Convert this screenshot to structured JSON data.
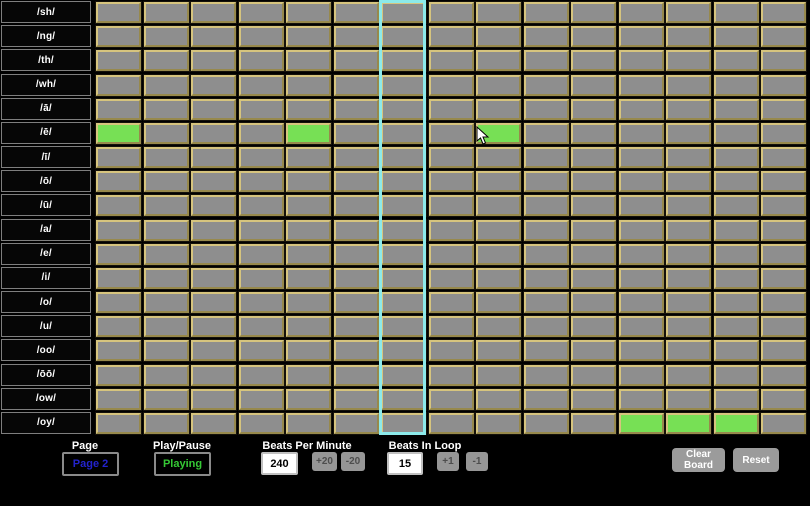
{
  "grid": {
    "row_labels": [
      "/sh/",
      "/ng/",
      "/th/",
      "/wh/",
      "/ā/",
      "/ē/",
      "/ī/",
      "/ō/",
      "/ū/",
      "/a/",
      "/e/",
      "/i/",
      "/o/",
      "/u/",
      "/oo/",
      "/ōō/",
      "/ow/",
      "/oy/"
    ],
    "num_columns": 15,
    "active_cells": [
      {
        "row": 5,
        "col": 0
      },
      {
        "row": 5,
        "col": 4
      },
      {
        "row": 5,
        "col": 8
      },
      {
        "row": 17,
        "col": 11
      },
      {
        "row": 17,
        "col": 12
      },
      {
        "row": 17,
        "col": 13
      }
    ],
    "playhead_column": 6,
    "colors": {
      "background": "#000000",
      "cell_fill": "#8e8e8e",
      "cell_border": "#c4b271",
      "active_cell": "#77e055",
      "playhead": "#8ceaea"
    }
  },
  "controls": {
    "page": {
      "label": "Page",
      "value": "Page 2",
      "value_color": "#2323cc"
    },
    "play_pause": {
      "label": "Play/Pause",
      "value": "Playing",
      "value_color": "#35c935"
    },
    "bpm": {
      "label": "Beats Per Minute",
      "value": "240",
      "increment_label": "+20",
      "decrement_label": "-20"
    },
    "beats_in_loop": {
      "label": "Beats In Loop",
      "value": "15",
      "increment_label": "+1",
      "decrement_label": "-1"
    },
    "clear_board_label": "Clear Board",
    "reset_label": "Reset"
  }
}
